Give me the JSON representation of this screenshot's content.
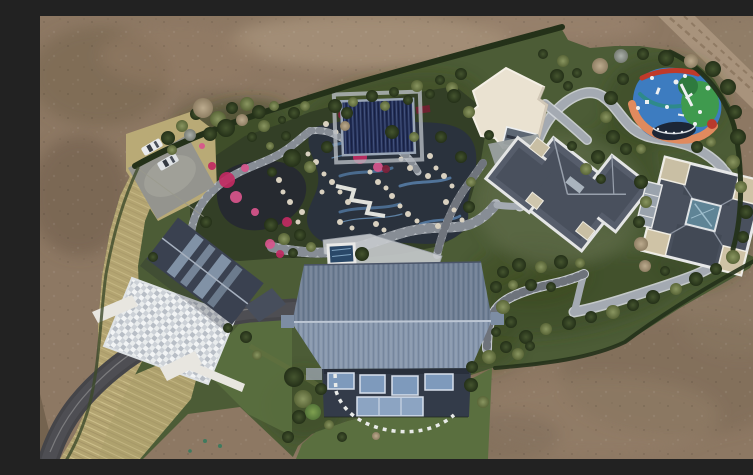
{
  "scene": {
    "type": "aerial-drone-photo",
    "description": "Top-down aerial view of a private landscaped estate: central water garden with winding stone paths and pink flower beds, navy pool pavilion, white flat-roof hall, two slate hip-roof villas, a large blue corrugated gable-roof residence, colorful children's playground, parking with cars, curving asphalt driveway, all surrounded by bare brown earth",
    "palette": {
      "dirt": "#8d7863",
      "dirt_light": "#a8927a",
      "dirt_dark": "#74634f",
      "dirt_road": "#a8937c",
      "grass_estate": "#4c5c36",
      "grass_lawn": "#5a6f3f",
      "grass_scrub": "#36451f",
      "hedge": "#243119",
      "dry_grass": "#b3a471",
      "asphalt": "#454549",
      "concrete": "#94948e",
      "path": "#a4aab2",
      "path_light": "#d3d6da",
      "garden_path": "#b2b7bd",
      "pond": "#262a30",
      "stream": "#2a323d",
      "water_tile": "#4a6b8e",
      "rock": "#d9d1c0",
      "flower_pink": "#c12a62",
      "flower_rose": "#d8558c",
      "flower_maroon": "#7e1f38",
      "pavilion_navy": "#232f58",
      "white_roof": "#eae2d1",
      "slate_roof": "#565d6b",
      "slate_dark": "#49505d",
      "parapet": "#e4e5e5",
      "tan_flat": "#c9bfa4",
      "skylight_teal": "#5f8496",
      "blue_roof_far": "#6d7d93",
      "blue_roof_near": "#8494ab",
      "facade": "#333b49",
      "window_blue": "#7e9abc",
      "glass_low": "#8ca4c2",
      "mosaic_base": "#ccd1d7",
      "west_roof": "#3a4150",
      "spa_water": "#2a4868",
      "wall_white": "#e8e6e0",
      "car_white": "#e9ebed",
      "play_blue": "#3d7cc0",
      "play_green": "#3f9a4e",
      "play_green_dark": "#2e7a3e",
      "play_orange": "#e08a5e",
      "play_red": "#c03a2a",
      "play_teal": "#2e8a8a",
      "trampoline": "#1c2636"
    }
  },
  "objects": {
    "playground": "multicolor rubber-surface playground with trampoline and white play equipment",
    "main_residence": "large blue corrugated gable-roof residence with glass facade",
    "west_house": "dark gabled house with skylights and mosaic stone courtyard",
    "northeast_house": "slate hip-roof villa with white parapets",
    "east_house": "square villa with central teal skylight and tan flat corners",
    "white_hall": "cream flat-roof hall",
    "pool_pavilion": "navy covered pool pavilion",
    "water_garden": "rock-edged ponds and blue-tiled streams with pink azalea beds",
    "vehicles": "two white cars in parking lot, two dark cars by villa"
  },
  "trees": [
    [
      128,
      122,
      7,
      "d"
    ],
    [
      142,
      110,
      6,
      "o"
    ],
    [
      156,
      98,
      6,
      "d"
    ],
    [
      163,
      92,
      10,
      "b"
    ],
    [
      178,
      103,
      8,
      "o"
    ],
    [
      192,
      92,
      6,
      "d"
    ],
    [
      207,
      88,
      7,
      "o"
    ],
    [
      150,
      119,
      6,
      "g"
    ],
    [
      170,
      118,
      7,
      "d"
    ],
    [
      186,
      112,
      9,
      "d"
    ],
    [
      202,
      104,
      6,
      "b"
    ],
    [
      219,
      96,
      7,
      "d"
    ],
    [
      234,
      90,
      5,
      "o"
    ],
    [
      224,
      110,
      6,
      "o"
    ],
    [
      242,
      104,
      4,
      "d"
    ],
    [
      132,
      134,
      5,
      "o"
    ],
    [
      212,
      121,
      5,
      "d"
    ],
    [
      254,
      97,
      6,
      "d"
    ],
    [
      265,
      90,
      5,
      "o"
    ],
    [
      246,
      120,
      5,
      "d"
    ],
    [
      230,
      130,
      4,
      "o"
    ],
    [
      295,
      90,
      7,
      "d"
    ],
    [
      313,
      86,
      5,
      "o"
    ],
    [
      332,
      80,
      6,
      "d"
    ],
    [
      354,
      76,
      5,
      "d"
    ],
    [
      377,
      70,
      6,
      "o"
    ],
    [
      400,
      64,
      5,
      "d"
    ],
    [
      307,
      97,
      6,
      "d"
    ],
    [
      345,
      90,
      5,
      "o"
    ],
    [
      368,
      84,
      5,
      "d"
    ],
    [
      305,
      110,
      5,
      "b"
    ],
    [
      390,
      78,
      5,
      "d"
    ],
    [
      412,
      72,
      6,
      "o"
    ],
    [
      421,
      58,
      6,
      "d"
    ],
    [
      414,
      80,
      7,
      "d"
    ],
    [
      429,
      96,
      6,
      "o"
    ],
    [
      449,
      119,
      5,
      "d"
    ],
    [
      517,
      60,
      7,
      "d"
    ],
    [
      523,
      45,
      6,
      "o"
    ],
    [
      503,
      38,
      5,
      "d"
    ],
    [
      537,
      57,
      5,
      "d"
    ],
    [
      528,
      70,
      5,
      "d"
    ],
    [
      560,
      50,
      8,
      "b"
    ],
    [
      581,
      40,
      7,
      "g"
    ],
    [
      603,
      38,
      6,
      "d"
    ],
    [
      626,
      42,
      8,
      "d"
    ],
    [
      651,
      45,
      7,
      "b"
    ],
    [
      673,
      53,
      8,
      "d"
    ],
    [
      688,
      71,
      8,
      "d"
    ],
    [
      695,
      96,
      7,
      "d"
    ],
    [
      698,
      121,
      8,
      "d"
    ],
    [
      693,
      146,
      7,
      "o"
    ],
    [
      583,
      63,
      6,
      "d"
    ],
    [
      571,
      82,
      7,
      "d"
    ],
    [
      566,
      101,
      6,
      "o"
    ],
    [
      573,
      121,
      7,
      "d"
    ],
    [
      586,
      133,
      6,
      "d"
    ],
    [
      601,
      133,
      5,
      "o"
    ],
    [
      657,
      131,
      6,
      "d"
    ],
    [
      671,
      126,
      5,
      "o"
    ],
    [
      558,
      141,
      7,
      "d"
    ],
    [
      546,
      153,
      6,
      "o"
    ],
    [
      561,
      163,
      5,
      "d"
    ],
    [
      532,
      130,
      5,
      "d"
    ],
    [
      701,
      171,
      6,
      "o"
    ],
    [
      706,
      196,
      7,
      "d"
    ],
    [
      703,
      221,
      6,
      "d"
    ],
    [
      693,
      241,
      7,
      "o"
    ],
    [
      676,
      253,
      6,
      "d"
    ],
    [
      656,
      263,
      7,
      "d"
    ],
    [
      636,
      273,
      6,
      "o"
    ],
    [
      613,
      281,
      7,
      "d"
    ],
    [
      593,
      289,
      6,
      "d"
    ],
    [
      573,
      296,
      7,
      "o"
    ],
    [
      551,
      301,
      6,
      "d"
    ],
    [
      529,
      307,
      7,
      "d"
    ],
    [
      506,
      313,
      6,
      "o"
    ],
    [
      486,
      321,
      7,
      "d"
    ],
    [
      466,
      331,
      6,
      "d"
    ],
    [
      449,
      341,
      7,
      "o"
    ],
    [
      432,
      351,
      6,
      "d"
    ],
    [
      605,
      250,
      6,
      "b"
    ],
    [
      625,
      255,
      5,
      "d"
    ],
    [
      601,
      166,
      7,
      "d"
    ],
    [
      606,
      186,
      6,
      "o"
    ],
    [
      599,
      206,
      6,
      "d"
    ],
    [
      601,
      228,
      7,
      "b"
    ],
    [
      521,
      246,
      7,
      "d"
    ],
    [
      501,
      251,
      6,
      "o"
    ],
    [
      479,
      249,
      7,
      "d"
    ],
    [
      463,
      256,
      6,
      "d"
    ],
    [
      473,
      269,
      5,
      "o"
    ],
    [
      491,
      269,
      6,
      "d"
    ],
    [
      511,
      271,
      5,
      "d"
    ],
    [
      540,
      247,
      5,
      "o"
    ],
    [
      456,
      271,
      6,
      "d"
    ],
    [
      463,
      291,
      7,
      "o"
    ],
    [
      471,
      306,
      6,
      "d"
    ],
    [
      456,
      316,
      5,
      "d"
    ],
    [
      478,
      338,
      6,
      "o"
    ],
    [
      490,
      330,
      5,
      "d"
    ],
    [
      252,
      142,
      9,
      "d"
    ],
    [
      270,
      151,
      6,
      "o"
    ],
    [
      232,
      156,
      5,
      "d"
    ],
    [
      287,
      131,
      6,
      "d"
    ],
    [
      352,
      116,
      7,
      "d"
    ],
    [
      374,
      121,
      5,
      "o"
    ],
    [
      401,
      121,
      6,
      "d"
    ],
    [
      421,
      141,
      6,
      "d"
    ],
    [
      431,
      166,
      5,
      "o"
    ],
    [
      429,
      191,
      6,
      "d"
    ],
    [
      322,
      238,
      7,
      "d"
    ],
    [
      260,
      219,
      6,
      "d"
    ],
    [
      271,
      231,
      5,
      "o"
    ],
    [
      231,
      209,
      7,
      "d"
    ],
    [
      244,
      223,
      6,
      "o"
    ],
    [
      253,
      237,
      5,
      "d"
    ],
    [
      113,
      241,
      5,
      "d"
    ],
    [
      166,
      206,
      6,
      "d"
    ],
    [
      254,
      361,
      10,
      "d"
    ],
    [
      263,
      383,
      9,
      "o"
    ],
    [
      259,
      401,
      7,
      "d"
    ],
    [
      273,
      396,
      8,
      "l"
    ],
    [
      281,
      373,
      6,
      "d"
    ],
    [
      289,
      409,
      5,
      "o"
    ],
    [
      248,
      421,
      6,
      "d"
    ],
    [
      302,
      421,
      5,
      "d"
    ],
    [
      431,
      369,
      7,
      "d"
    ],
    [
      443,
      386,
      6,
      "o"
    ],
    [
      336,
      420,
      4,
      "b"
    ],
    [
      206,
      321,
      6,
      "d"
    ],
    [
      217,
      339,
      5,
      "o"
    ],
    [
      188,
      312,
      5,
      "d"
    ]
  ],
  "flowers": [
    [
      187,
      164,
      8,
      "#c12a62"
    ],
    [
      196,
      181,
      6,
      "#d8558c"
    ],
    [
      205,
      152,
      4,
      "#d8558c"
    ],
    [
      247,
      206,
      5,
      "#c12a62"
    ],
    [
      230,
      228,
      5,
      "#d8558c"
    ],
    [
      320,
      141,
      7,
      "#c12a62"
    ],
    [
      338,
      151,
      5,
      "#d8558c"
    ],
    [
      346,
      153,
      4,
      "#7e1f38"
    ],
    [
      302,
      99,
      4,
      "#7e1f38"
    ],
    [
      356,
      132,
      4,
      "#7e1f38"
    ],
    [
      240,
      238,
      4,
      "#c12a62"
    ],
    [
      215,
      196,
      4,
      "#d8558c"
    ],
    [
      172,
      150,
      4,
      "#c12a62"
    ],
    [
      162,
      130,
      3,
      "#d8558c"
    ]
  ],
  "stones": [
    [
      268,
      138,
      2.5
    ],
    [
      276,
      146,
      3
    ],
    [
      284,
      158,
      2.5
    ],
    [
      292,
      166,
      3
    ],
    [
      300,
      176,
      2.5
    ],
    [
      308,
      186,
      3
    ],
    [
      352,
      180,
      3
    ],
    [
      360,
      190,
      2.5
    ],
    [
      368,
      198,
      3
    ],
    [
      377,
      205,
      2.5
    ],
    [
      388,
      160,
      3
    ],
    [
      396,
      152,
      2.5
    ],
    [
      404,
      160,
      3
    ],
    [
      412,
      170,
      2.5
    ],
    [
      262,
      196,
      3
    ],
    [
      258,
      206,
      2.5
    ],
    [
      300,
      206,
      3
    ],
    [
      312,
      212,
      2.5
    ],
    [
      336,
      208,
      3
    ],
    [
      344,
      214,
      2.5
    ],
    [
      332,
      120,
      3
    ],
    [
      344,
      126,
      2.5
    ],
    [
      390,
      140,
      3
    ],
    [
      282,
      176,
      2.5
    ],
    [
      250,
      186,
      3
    ],
    [
      243,
      176,
      2.5
    ],
    [
      239,
      164,
      3
    ],
    [
      330,
      156,
      2.5
    ],
    [
      338,
      166,
      3
    ],
    [
      346,
      172,
      2.5
    ],
    [
      406,
      186,
      3
    ],
    [
      414,
      194,
      2.5
    ],
    [
      398,
      210,
      3
    ],
    [
      422,
      204,
      2.5
    ],
    [
      286,
      108,
      3
    ],
    [
      296,
      116,
      2.5
    ],
    [
      306,
      124,
      3
    ],
    [
      361,
      143,
      2.5
    ],
    [
      370,
      152,
      3
    ]
  ],
  "playground_marks": [
    {
      "x": 618,
      "y": 75,
      "w": 3,
      "h": 7,
      "rot": 20
    },
    {
      "x": 636,
      "y": 66,
      "r": 2.5
    },
    {
      "x": 649,
      "y": 80,
      "w": 8,
      "h": 2.5,
      "rot": -35
    },
    {
      "x": 660,
      "y": 96,
      "r": 2
    },
    {
      "x": 627,
      "y": 91,
      "r": 2
    },
    {
      "x": 607,
      "y": 86,
      "w": 4,
      "h": 4,
      "rot": 0
    },
    {
      "x": 668,
      "y": 72,
      "r": 2.5
    },
    {
      "x": 645,
      "y": 60,
      "r": 2
    },
    {
      "x": 612,
      "y": 62,
      "r": 2
    },
    {
      "x": 655,
      "y": 108,
      "r": 2
    },
    {
      "x": 598,
      "y": 92,
      "r": 2
    },
    {
      "x": 641,
      "y": 99,
      "w": 6,
      "h": 2,
      "rot": 10
    }
  ],
  "trampoline_dots": [
    [
      618,
      113
    ],
    [
      626,
      116
    ],
    [
      634,
      117
    ],
    [
      642,
      116
    ]
  ],
  "cars_parking": [
    {
      "x": 112,
      "y": 131,
      "rot": -30,
      "w": 21,
      "h": 9,
      "body": "#e9ebed"
    },
    {
      "x": 128,
      "y": 146,
      "rot": -30,
      "w": 21,
      "h": 9,
      "body": "#dfe3e6"
    }
  ],
  "cars_house": [
    {
      "x": 509,
      "y": 138,
      "rot": 15,
      "w": 13,
      "h": 6,
      "body": "#3a3f46"
    },
    {
      "x": 521,
      "y": 131,
      "rot": 15,
      "w": 13,
      "h": 6,
      "body": "#2e3338"
    }
  ]
}
